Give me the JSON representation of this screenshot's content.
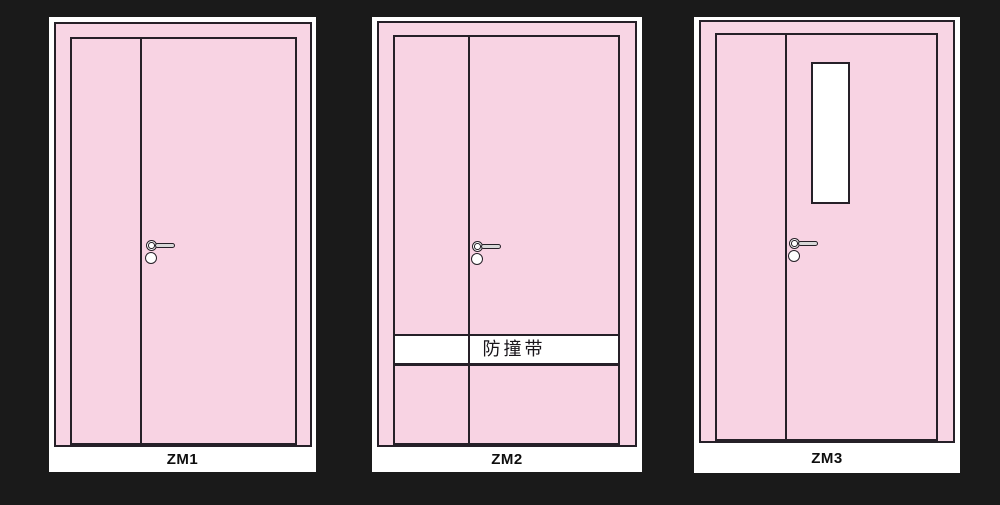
{
  "colors": {
    "background": "#1a1a1a",
    "card": "#ffffff",
    "door_pink": "#f8d3e3",
    "frame_pink": "#f8d5e4",
    "line": "#262028",
    "lever": "#d8d8d8"
  },
  "panels": [
    {
      "label": "ZM1"
    },
    {
      "label": "ZM2",
      "band_label": "防撞带"
    },
    {
      "label": "ZM3"
    }
  ]
}
